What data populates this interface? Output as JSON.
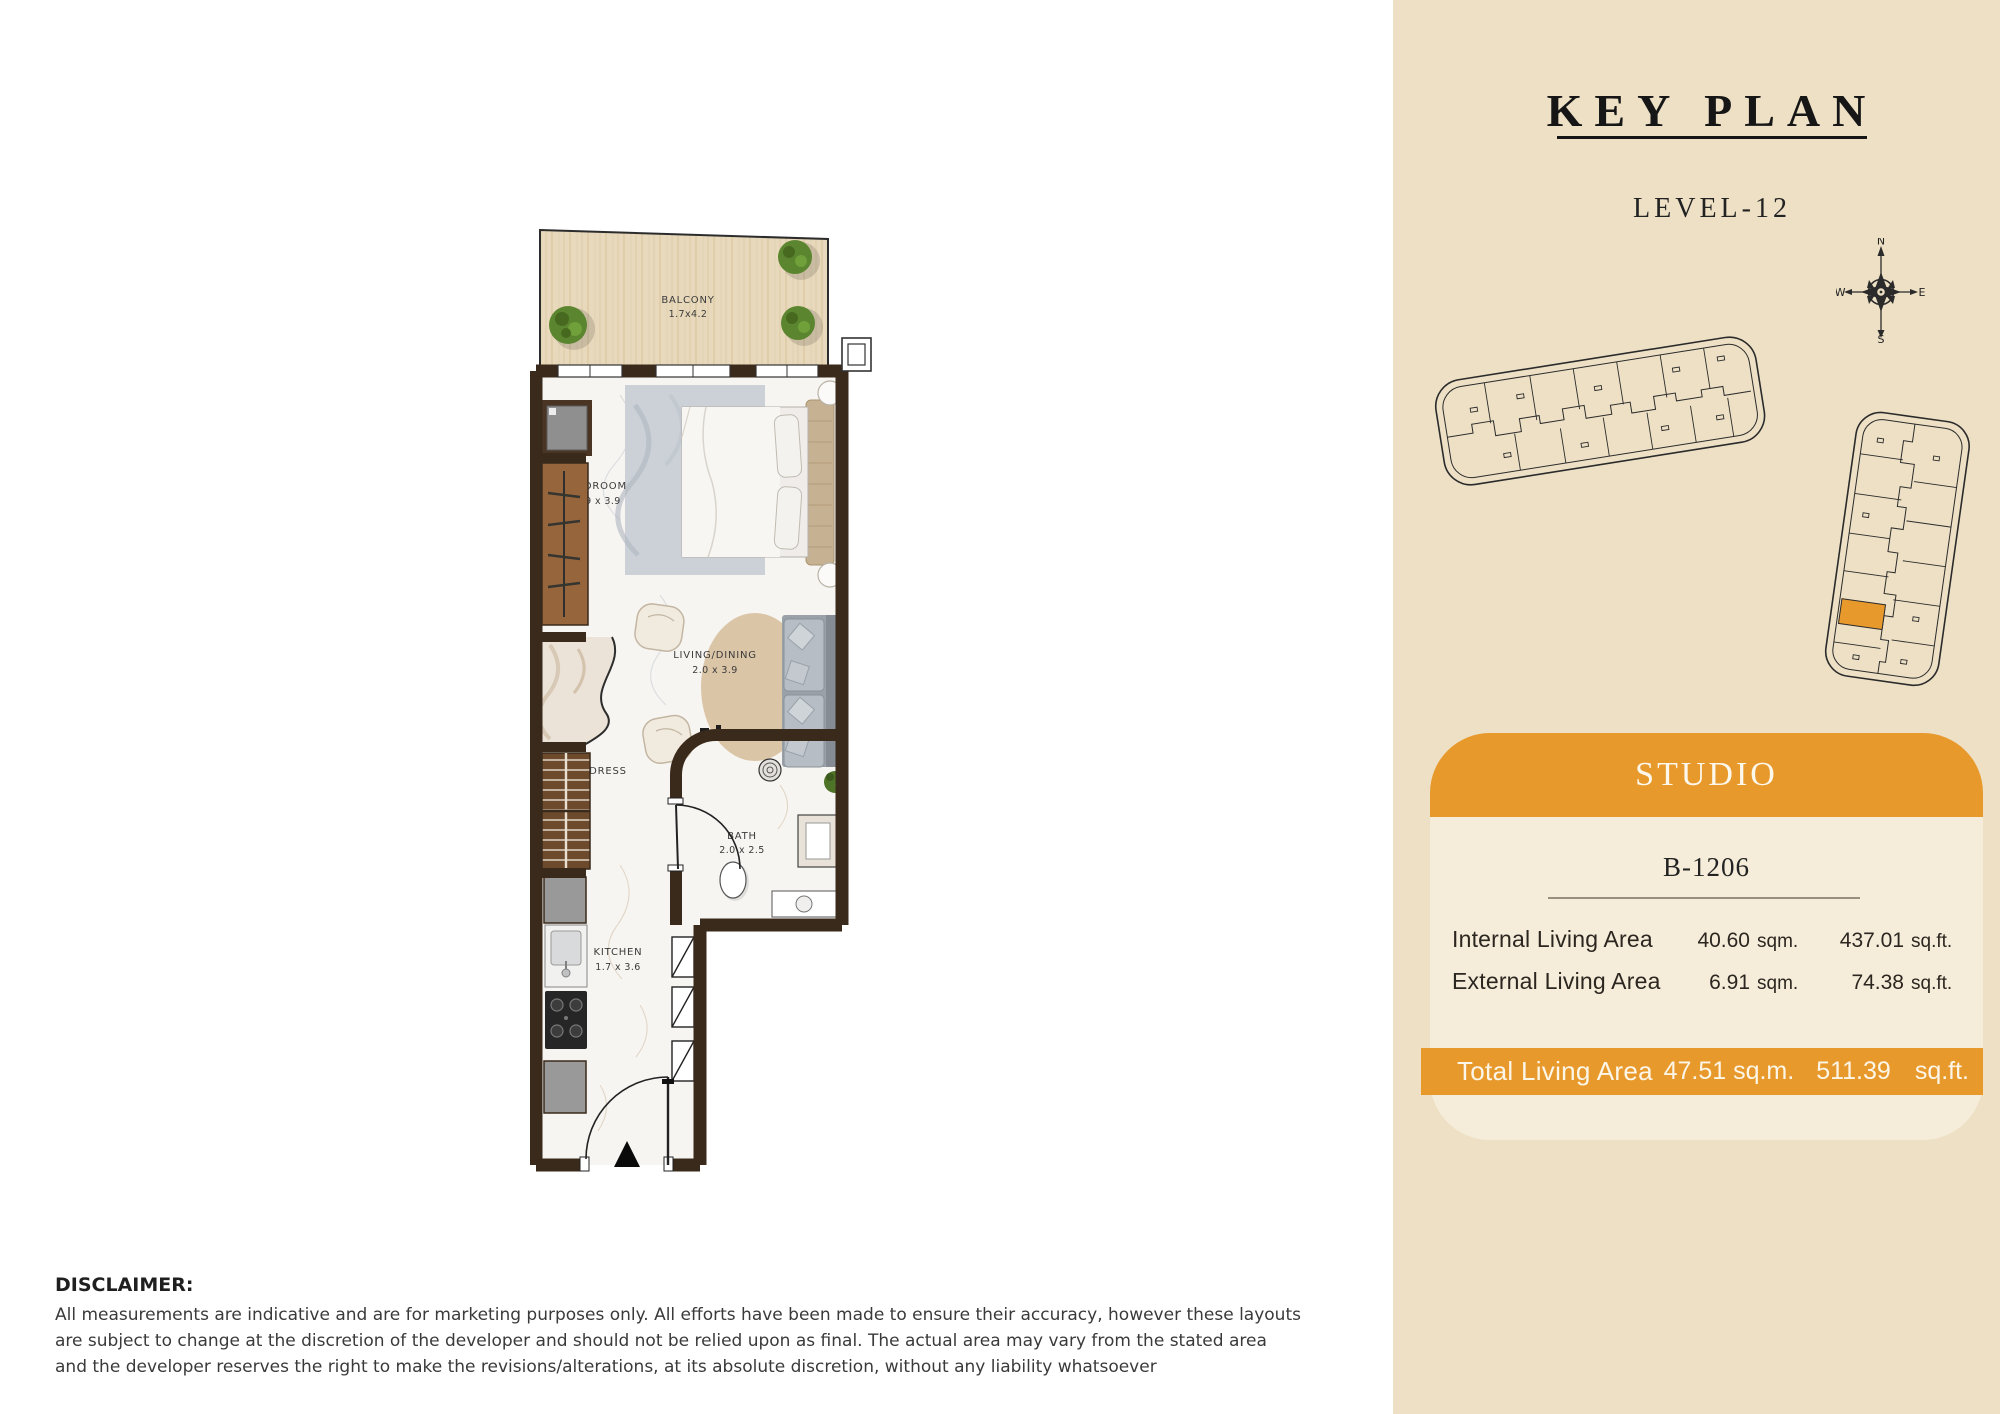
{
  "key_plan": {
    "title": "KEY PLAN",
    "level": "LEVEL-12",
    "compass": {
      "n": "N",
      "e": "E",
      "s": "S",
      "w": "W"
    }
  },
  "unit_card": {
    "type_label": "STUDIO",
    "unit_number": "B-1206",
    "rows": [
      {
        "label": "Internal Living Area",
        "sqm_value": "40.60",
        "sqm_unit": "sqm.",
        "sqft_value": "437.01",
        "sqft_unit": "sq.ft."
      },
      {
        "label": "External Living Area",
        "sqm_value": "6.91",
        "sqm_unit": "sqm.",
        "sqft_value": "74.38",
        "sqft_unit": "sq.ft."
      }
    ],
    "total": {
      "label": "Total Living Area",
      "sqm": "47.51 sq.m.",
      "sqft_value": "511.39",
      "sqft_unit": "sq.ft."
    }
  },
  "floor_plan": {
    "rooms": {
      "balcony": {
        "name": "BALCONY",
        "dims": "1.7x4.2"
      },
      "bedroom": {
        "name": "BEDROOM",
        "dims": "2.9 x 3.9"
      },
      "living": {
        "name": "LIVING/DINING",
        "dims": "2.0 x 3.9"
      },
      "dress": {
        "name": "DRESS",
        "dims": ""
      },
      "bath": {
        "name": "BATH",
        "dims": "2.0 x 2.5"
      },
      "kitchen": {
        "name": "KITCHEN",
        "dims": "1.7 x 3.6"
      }
    }
  },
  "disclaimer": {
    "heading": "DISCLAIMER:",
    "lines": [
      "All measurements are indicative and are for marketing purposes only. All efforts have been made to ensure their accuracy, however these layouts",
      "are subject to change at the discretion of the developer and should not be relied upon as final. The actual area may vary from the stated area",
      "and the developer reserves the right to make the revisions/alterations, at its absolute discretion, without any liability whatsoever"
    ]
  },
  "colors": {
    "panel_beige": "#EDE0C5",
    "accent_orange": "#E8992C",
    "card_cream": "#F5EDDA",
    "wall_brown": "#3A2A1B",
    "balcony_wood": "#E8D9BC",
    "marble_floor": "#F7F5F2",
    "highlight_unit": "#E8992C"
  }
}
